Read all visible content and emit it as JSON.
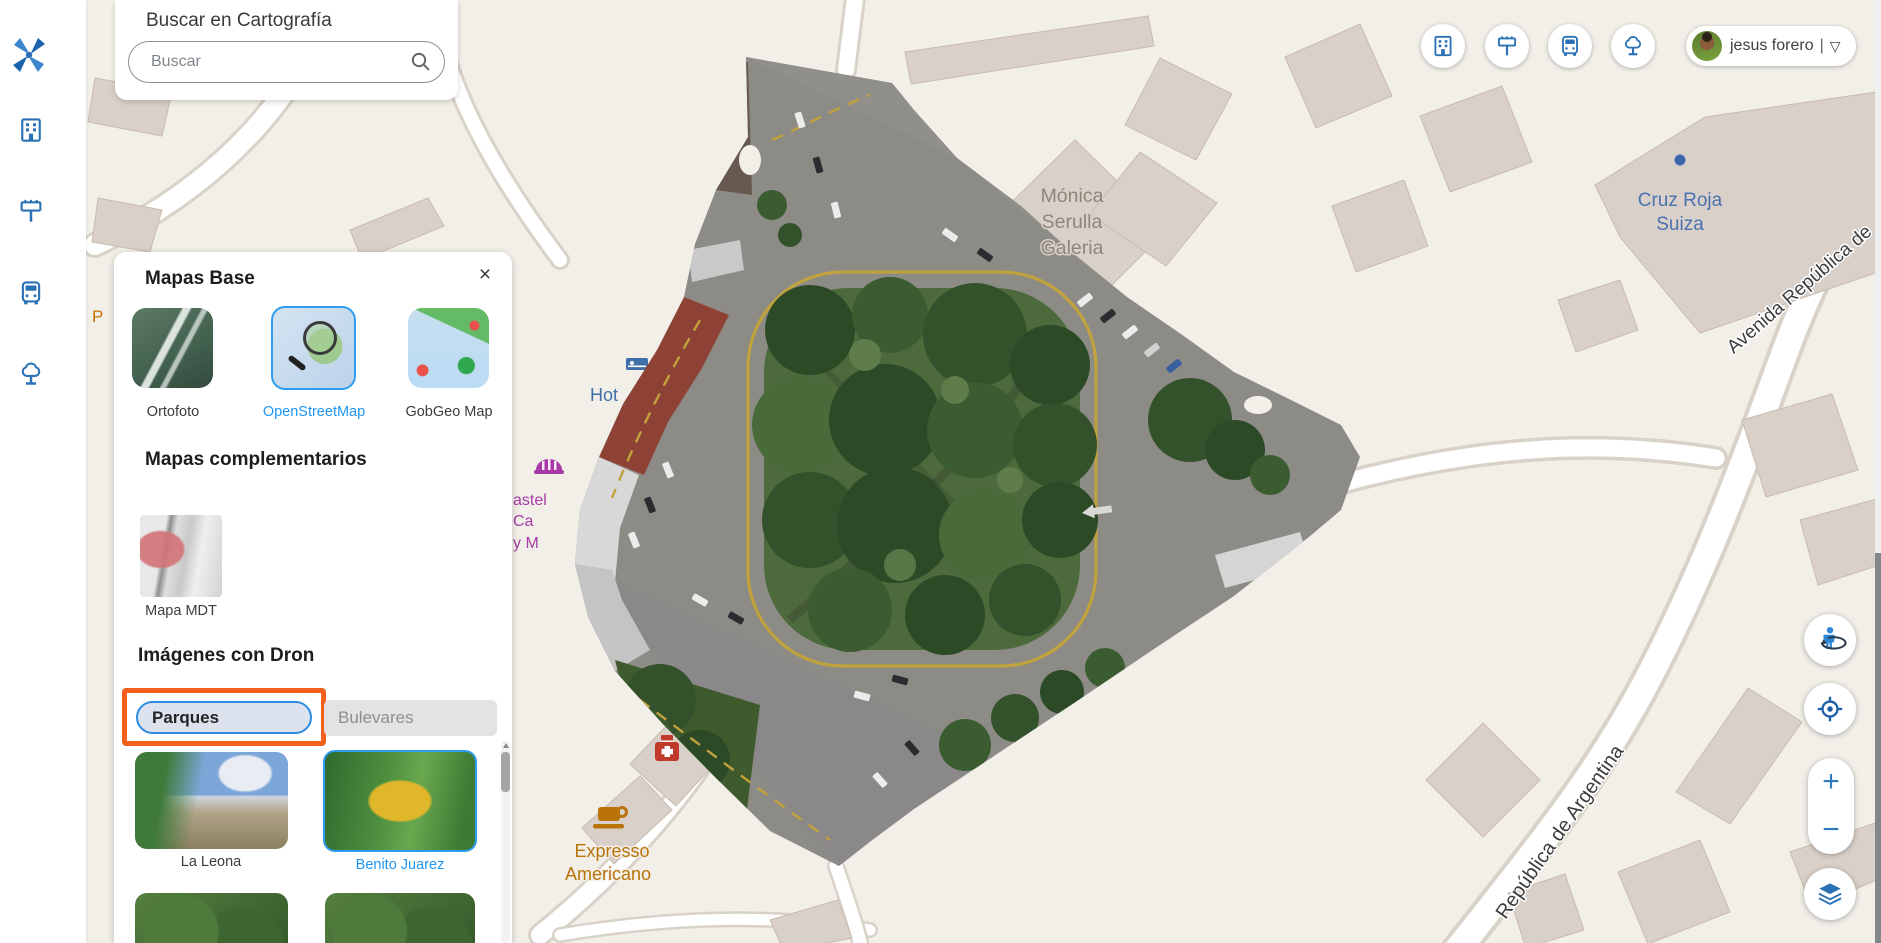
{
  "theme": {
    "accent_blue": "#2a72b5",
    "selection_blue": "#2196f3",
    "highlight_orange": "#f4611d"
  },
  "search": {
    "title": "Buscar en Cartografía",
    "placeholder": "Buscar"
  },
  "panel": {
    "title": "Mapas Base",
    "close_icon": "×",
    "base_maps": [
      {
        "label": "Ortofoto",
        "selected": false
      },
      {
        "label": "OpenStreetMap",
        "selected": true
      },
      {
        "label": "GobGeo Map",
        "selected": false
      }
    ],
    "complementary_title": "Mapas complementarios",
    "complementary_maps": [
      {
        "label": "Mapa MDT"
      }
    ],
    "drone_title": "Imágenes con Dron",
    "tabs": [
      {
        "label": "Parques",
        "selected": true,
        "highlighted": true
      },
      {
        "label": "Bulevares",
        "selected": false
      }
    ],
    "drone_images": [
      {
        "label": "La Leona",
        "selected": false
      },
      {
        "label": "Benito Juarez",
        "selected": true
      }
    ]
  },
  "topbar": {
    "buttons": [
      "building",
      "billboard",
      "bus",
      "tree"
    ],
    "user": {
      "name": "jesus forero",
      "divider": "|",
      "dropdown_icon": "▽"
    }
  },
  "controls": {
    "zoom_in": "+",
    "zoom_out": "−"
  },
  "map_labels": {
    "gallery": [
      "Mónica",
      "Serulla",
      "Galeria"
    ],
    "red_cross": [
      "Cruz Roja",
      "Suiza"
    ],
    "avenue": "Avenida República de",
    "argentina": "República de Argentina",
    "hotel": "Hot",
    "cafe": [
      "Expresso",
      "Americano"
    ],
    "bakery": [
      "astel",
      "Ca",
      "y M"
    ],
    "p_fragment": "P"
  }
}
